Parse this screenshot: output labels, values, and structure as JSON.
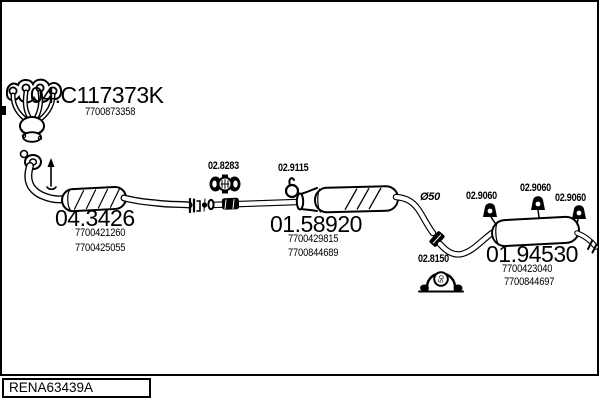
{
  "page": {
    "background": "#ffffff",
    "ink": "#000000",
    "kind": "exhaust-system-parts-diagram"
  },
  "footer": {
    "drawing_number": "RENA63439A"
  },
  "parts": {
    "manifold": {
      "code": "04.C117373K",
      "refs": [
        "7700873358"
      ]
    },
    "catalyst": {
      "code": "04.3426",
      "refs": [
        "7700421260",
        "7700425055"
      ]
    },
    "clamp_front": {
      "code": "02.8283"
    },
    "hanger_mid": {
      "code": "02.9115"
    },
    "mid_muffler": {
      "code": "01.58920",
      "refs": [
        "7700429815",
        "7700844689"
      ]
    },
    "pipe_diameter": {
      "label": "Ø50"
    },
    "clamp_rear": {
      "code": "02.8150",
      "badge": "50"
    },
    "rear_hanger_1": {
      "code": "02.9060"
    },
    "rear_hanger_2": {
      "code": "02.9060"
    },
    "rear_hanger_3": {
      "code": "02.9060"
    },
    "rear_muffler": {
      "code": "01.94530",
      "refs": [
        "7700423040",
        "7700844697"
      ]
    }
  }
}
